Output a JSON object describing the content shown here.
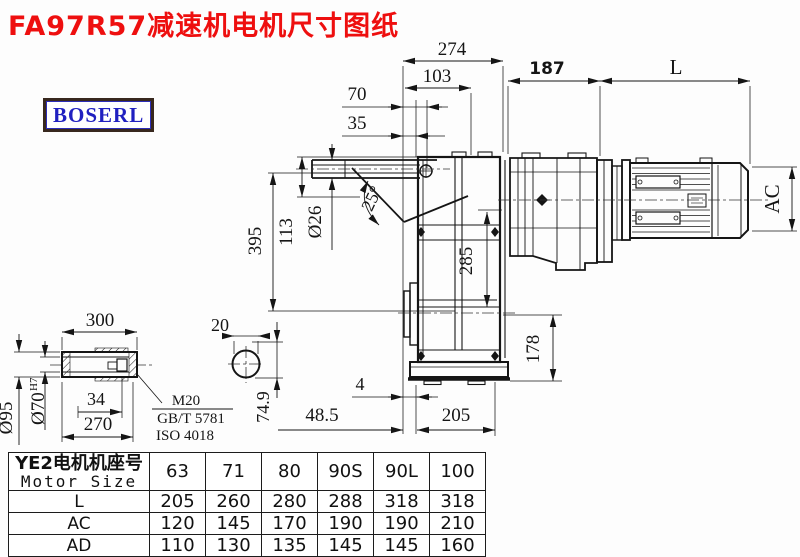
{
  "title": "FA97R57减速机电机尺寸图纸",
  "logo": "BOSERL",
  "colors": {
    "title_red": "#ee0f0f",
    "logo_blue": "#2020c0",
    "logo_border": "#38281e",
    "line": "#151515"
  },
  "drawing": {
    "dims": {
      "d274": "274",
      "d103": "103",
      "d70": "70",
      "d35": "35",
      "d187": "187",
      "dL": "L",
      "dAC": "AC",
      "d395": "395",
      "d113": "113",
      "d26": "Ø26",
      "d25": "25°",
      "d285": "285",
      "d178": "178",
      "d4": "4",
      "d485": "48.5",
      "d205": "205"
    },
    "shaft_view": {
      "d300": "300",
      "d95": "Ø95",
      "d70": "Ø70",
      "d70_sup": "H7",
      "d34": "34",
      "d270": "270",
      "note1": "M20",
      "note2": "GB/T 5781",
      "note3": "ISO 4018"
    },
    "key_view": {
      "d20": "20",
      "d749": "74.9"
    }
  },
  "table": {
    "header": {
      "motor_size_cn": "YE2电机机座号",
      "motor_size_en": "Motor Size",
      "sizes": [
        "63",
        "71",
        "80",
        "90S",
        "90L",
        "100"
      ]
    },
    "rows": [
      {
        "label": "L",
        "values": [
          "205",
          "260",
          "280",
          "288",
          "318",
          "318"
        ]
      },
      {
        "label": "AC",
        "values": [
          "120",
          "145",
          "170",
          "190",
          "190",
          "210"
        ]
      },
      {
        "label": "AD",
        "values": [
          "110",
          "130",
          "135",
          "145",
          "145",
          "160"
        ]
      }
    ]
  }
}
